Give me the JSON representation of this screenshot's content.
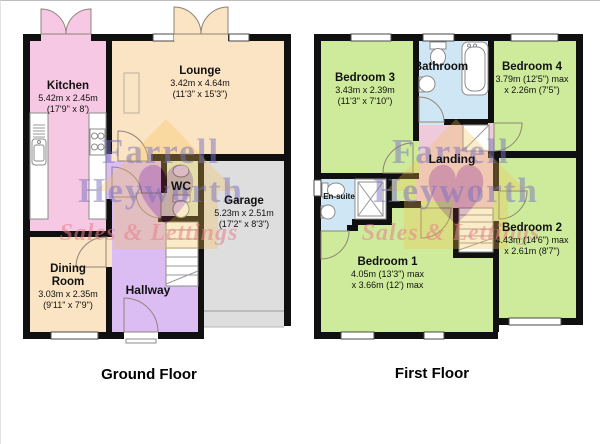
{
  "watermark": {
    "line1": "Farrell",
    "line2": "Heyworth",
    "line3": "Sales & Lettings"
  },
  "floors": {
    "ground": {
      "title": "Ground Floor",
      "rooms": {
        "kitchen": {
          "name": "Kitchen",
          "metric": "5.42m x 2.45m",
          "imperial": "(17'9\" x 8')"
        },
        "lounge": {
          "name": "Lounge",
          "metric": "3.42m x 4.64m",
          "imperial": "(11'3\" x 15'3\")"
        },
        "wc": {
          "name": "WC"
        },
        "garage": {
          "name": "Garage",
          "metric": "5.23m x 2.51m",
          "imperial": "(17'2\" x 8'3\")"
        },
        "dining": {
          "name": "Dining Room",
          "metric": "3.03m x 2.35m",
          "imperial": "(9'11\" x 7'9\")"
        },
        "hallway": {
          "name": "Hallway"
        }
      }
    },
    "first": {
      "title": "First Floor",
      "rooms": {
        "bedroom3": {
          "name": "Bedroom 3",
          "metric": "3.43m x 2.39m",
          "imperial": "(11'3\" x 7'10\")"
        },
        "bathroom": {
          "name": "Bathroom"
        },
        "bedroom4": {
          "name": "Bedroom 4",
          "metric": "3.79m (12'5\") max",
          "imperial": "x 2.26m (7'5\")"
        },
        "landing": {
          "name": "Landing"
        },
        "ensuite": {
          "name": "En-suite"
        },
        "bedroom1": {
          "name": "Bedroom 1",
          "metric": "4.05m (13'3\") max",
          "imperial": "x 3.66m (12') max"
        },
        "bedroom2": {
          "name": "Bedroom 2",
          "metric": "4.43m (14'6\") max",
          "imperial": "x 2.61m (8'7\")"
        }
      }
    }
  },
  "colors": {
    "wall": "#101010",
    "kitchen": "#f6c8e4",
    "lounge": "#fbe4c4",
    "wc": "#dcead0",
    "garage": "#dedede",
    "hallway": "#dcbdf3",
    "landing": "#eecadb",
    "bedroom": "#cdeb9b",
    "bathroom": "#cfe7f4",
    "wmtext": "#7a72c0",
    "wmsales": "#e87f8d",
    "logoyellow": "#f5c14f",
    "logored": "#8d2440"
  }
}
